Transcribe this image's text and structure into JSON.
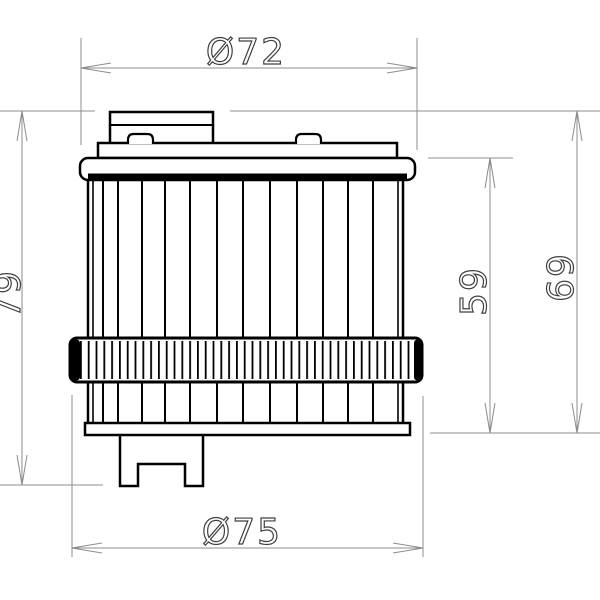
{
  "drawing": {
    "background": "#ffffff",
    "outline_color": "#000000",
    "dimension_line_color": "#8c8c8c",
    "dimension_text_color": "#404040",
    "dimensions": {
      "top_diameter": {
        "label": "Ø72"
      },
      "bottom_diameter": {
        "label": "Ø75"
      },
      "overall_height": {
        "label": "79"
      },
      "element_height": {
        "label": "59"
      },
      "body_height": {
        "label": "69"
      }
    }
  }
}
